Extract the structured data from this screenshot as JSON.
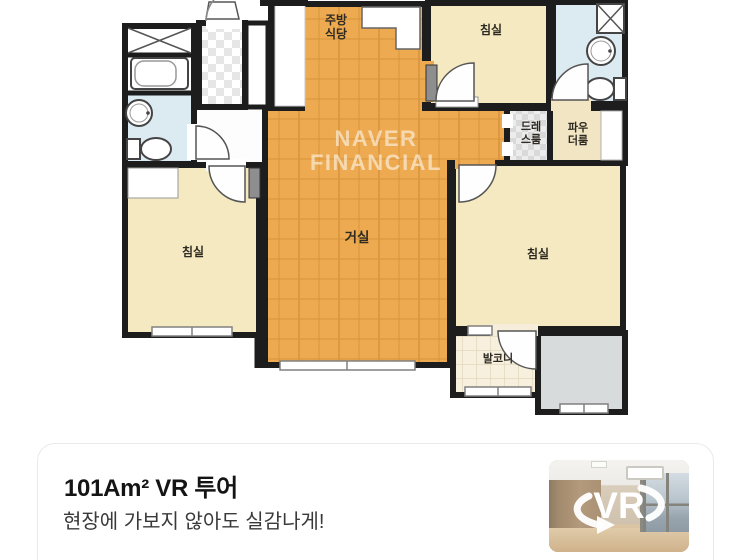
{
  "floor_plan": {
    "watermark": "NAVER FINANCIAL",
    "rooms": {
      "kitchen_dining": "주방\n식당",
      "bedroom_top_right": "침실",
      "bedroom_left": "침실",
      "bedroom_bottom_right": "침실",
      "living_room": "거실",
      "dress_room": "드레\n스룸",
      "powder_room": "파우\n더룸",
      "balcony": "발코니"
    }
  },
  "vr_card": {
    "title": "101Am² VR 투어",
    "subtitle": "현장에 가보지 않아도 실감나게!",
    "vr_badge": "VR"
  },
  "colors": {
    "wood_floor": "#edaa50",
    "room_beige": "#f4e9c1",
    "bath_blue": "#dceaf2",
    "wall": "#1d1d1d",
    "card_border": "#e9e9e9"
  }
}
